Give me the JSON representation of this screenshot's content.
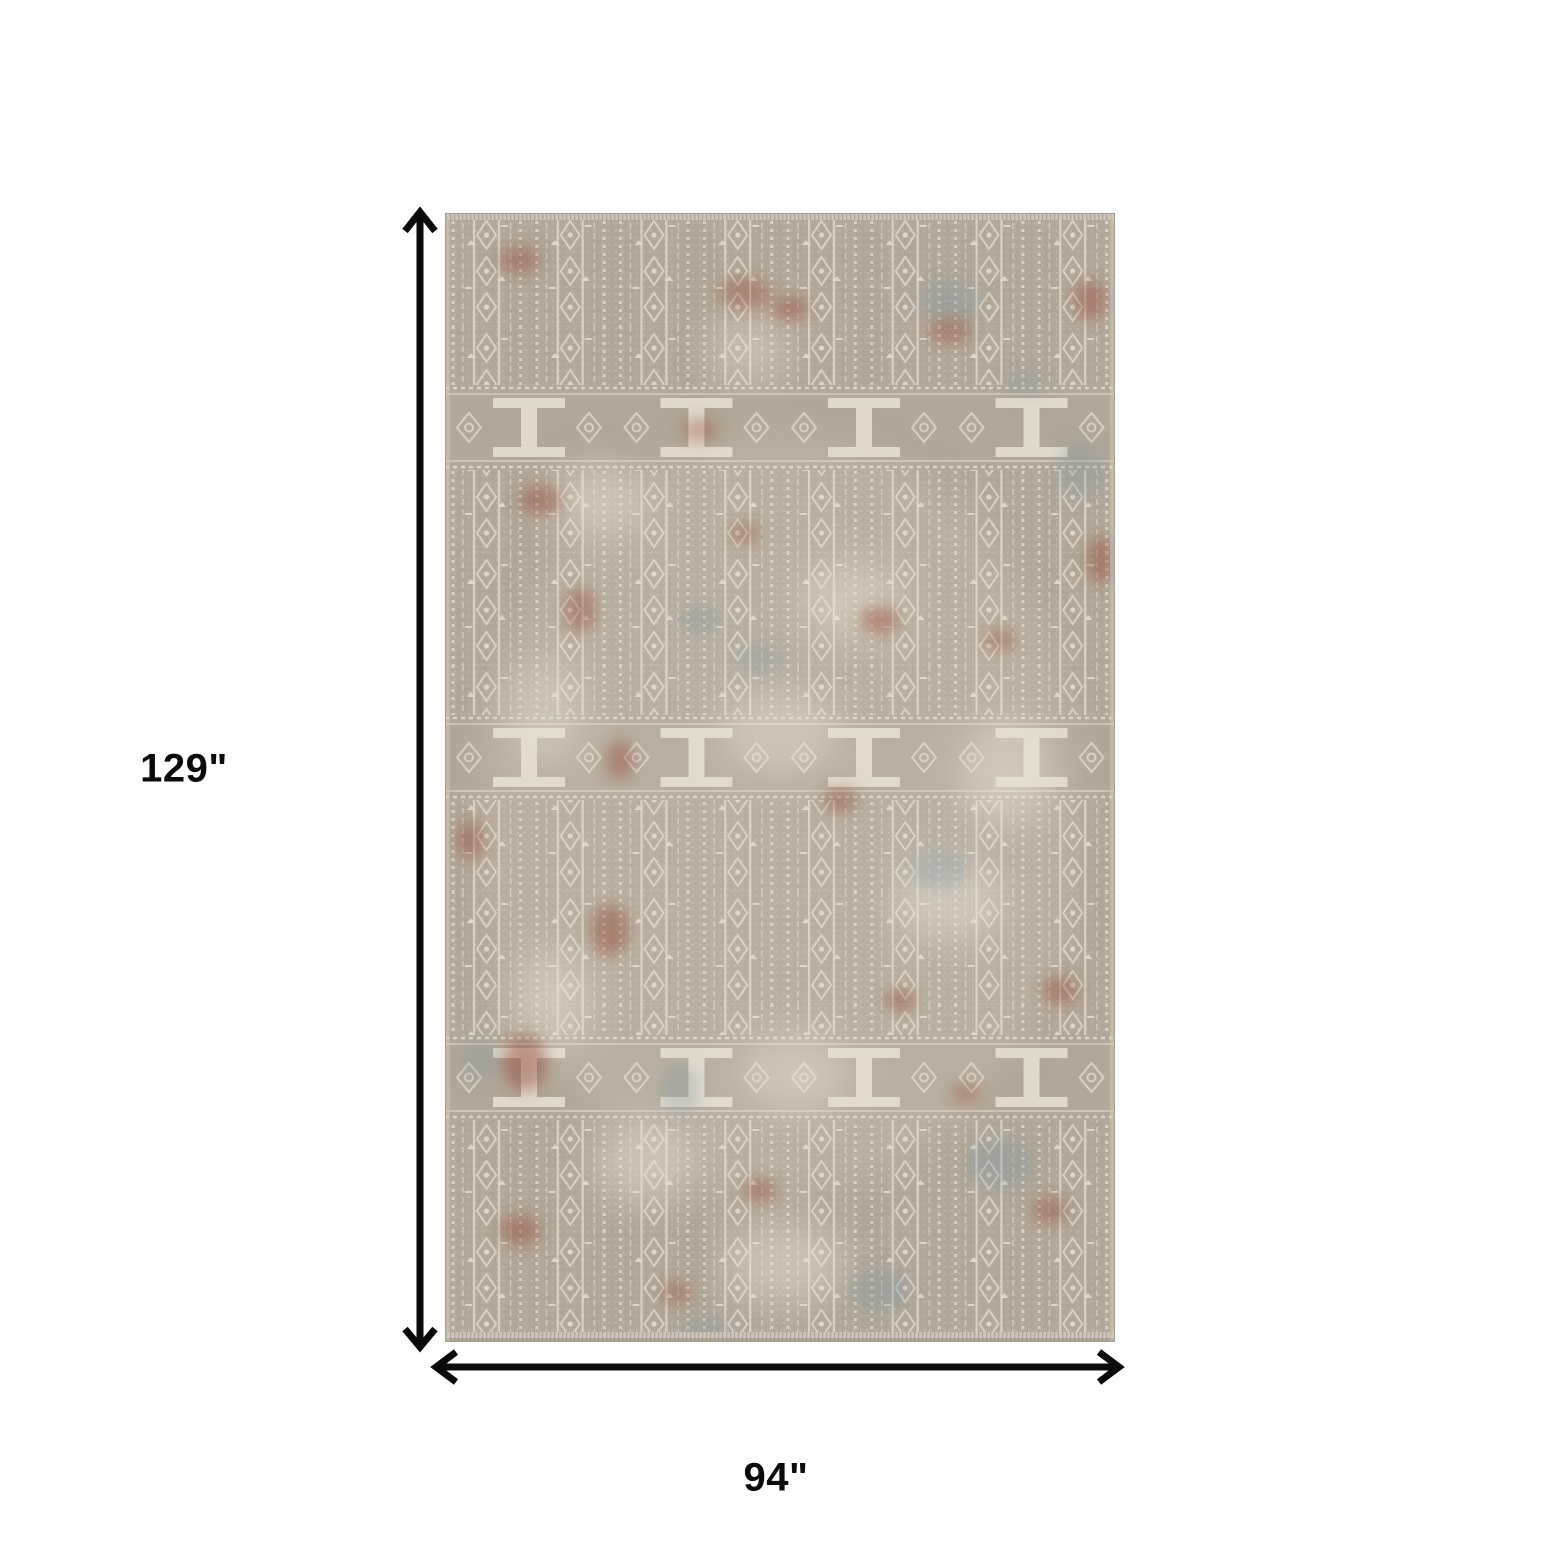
{
  "diagram": {
    "height_label": "129\"",
    "width_label": "94\"",
    "rug_alt": "Distressed taupe and ivory geometric oriental area rug with rust red and slate blue accents"
  },
  "colors": {
    "background": "#ffffff",
    "ink": "#0a0a0a",
    "rug_base": "#b2a798",
    "rug_base_dark": "#a3988a",
    "rug_ivory": "#e9e2d4",
    "rug_rust": "#8e4233",
    "rug_blue": "#7c96a1",
    "rug_edge": "#a79d8f",
    "rug_fringe": "#cfc9bc",
    "rug_shadow": "#8f8678"
  }
}
